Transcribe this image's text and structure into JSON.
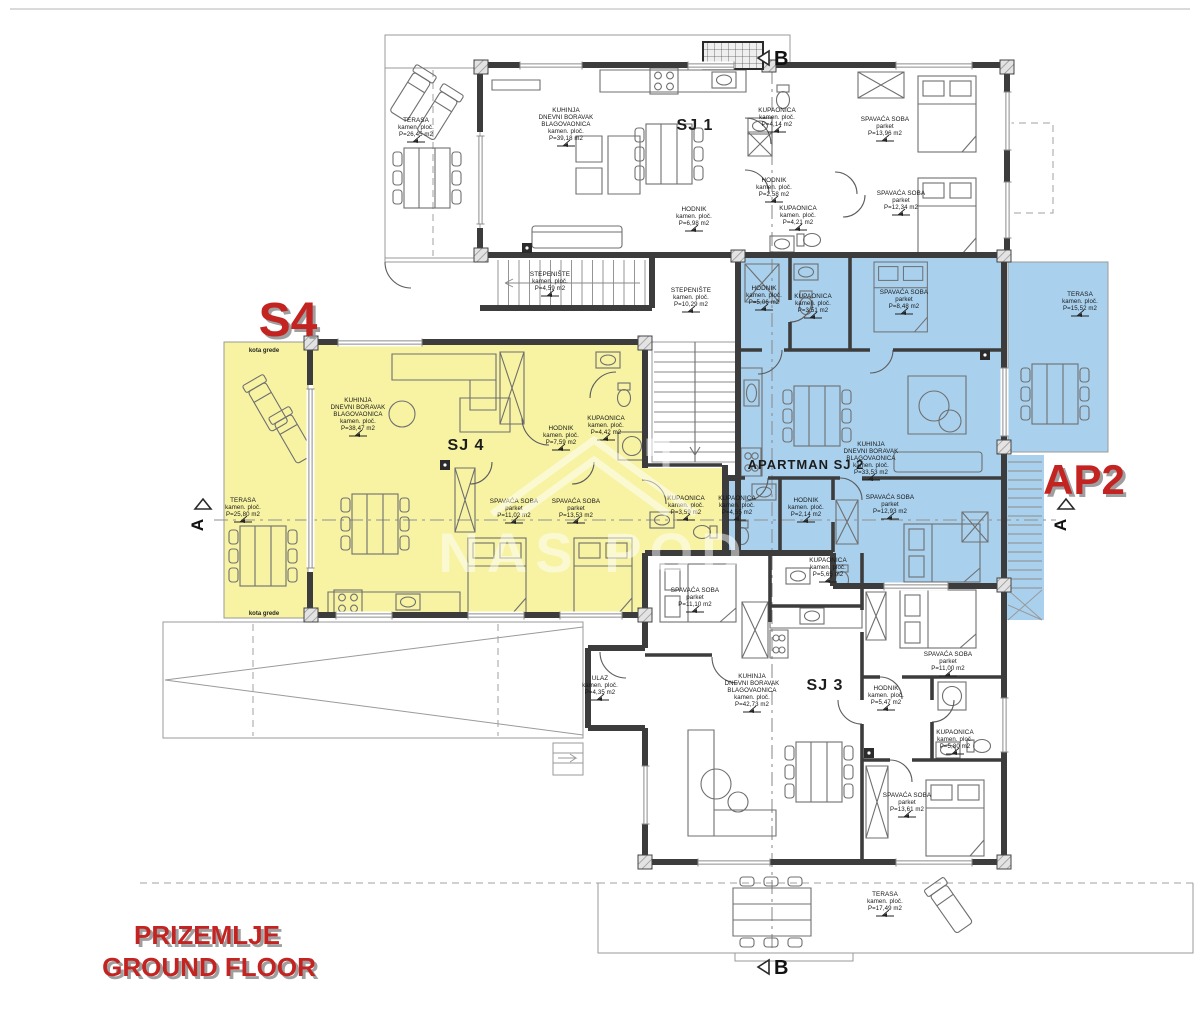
{
  "drawing_type": "floor-plan",
  "floor_title": {
    "croatian": "PRIZEMLJE",
    "english": "GROUND FLOOR"
  },
  "watermark": {
    "text": "NAS POD"
  },
  "colors": {
    "s4_fill": "#f7f3a3",
    "ap2_fill": "#a9d1ee",
    "red": "#c32422",
    "wall": "#3c3c3c"
  },
  "red_labels": [
    {
      "name": "unit-highlight-s4",
      "text": "S4",
      "x": 288,
      "y": 336,
      "size": 48
    },
    {
      "name": "unit-highlight-ap2",
      "text": "AP2",
      "x": 1084,
      "y": 494,
      "size": 42
    },
    {
      "name": "floor-title-croatian",
      "text": "PRIZEMLJE",
      "x": 207,
      "y": 944,
      "size": 26
    },
    {
      "name": "floor-title-english",
      "text": "GROUND FLOOR",
      "x": 209,
      "y": 976,
      "size": 26
    }
  ],
  "units": [
    {
      "id": "sj1",
      "label": "SJ 1",
      "x": 695,
      "y": 130,
      "size": 16
    },
    {
      "id": "sj4",
      "label": "SJ 4",
      "x": 466,
      "y": 450,
      "size": 16
    },
    {
      "id": "apartman-sj2",
      "label": "APARTMAN SJ 2",
      "x": 806,
      "y": 469,
      "size": 13
    },
    {
      "id": "sj3",
      "label": "SJ 3",
      "x": 825,
      "y": 690,
      "size": 16
    }
  ],
  "rooms": [
    {
      "unit": "SJ 1",
      "lines": [
        "TERASA",
        "kamen. ploč.",
        "P=26,45 m2"
      ],
      "x": 416,
      "y": 116
    },
    {
      "unit": "SJ 1",
      "lines": [
        "KUHINJA",
        "DNEVNI BORAVAK",
        "BLAGOVAONICA",
        "kamen. ploč.",
        "P=39,18 m2"
      ],
      "x": 566,
      "y": 106
    },
    {
      "unit": "SJ 1",
      "lines": [
        "KUPAONICA",
        "kamen. ploč.",
        "P=4,14 m2"
      ],
      "x": 777,
      "y": 106
    },
    {
      "unit": "SJ 1",
      "lines": [
        "SPAVAĆA SOBA",
        "parket",
        "P=13,96 m2"
      ],
      "x": 885,
      "y": 115
    },
    {
      "unit": "SJ 1",
      "lines": [
        "HODNIK",
        "kamen. ploč.",
        "P=2,58 m2"
      ],
      "x": 774,
      "y": 176
    },
    {
      "unit": "SJ 1",
      "lines": [
        "KUPAONICA",
        "kamen. ploč.",
        "P=4,21 m2"
      ],
      "x": 798,
      "y": 204
    },
    {
      "unit": "SJ 1",
      "lines": [
        "SPAVAĆA SOBA",
        "parket",
        "P=12,34 m2"
      ],
      "x": 901,
      "y": 189
    },
    {
      "unit": "SJ 1",
      "lines": [
        "HODNIK",
        "kamen. ploč.",
        "P=6,98 m2"
      ],
      "x": 694,
      "y": 205
    },
    {
      "unit": "zajedničko",
      "lines": [
        "STEPENIŠTE",
        "kamen. ploč.",
        "P=4,59 m2"
      ],
      "x": 550,
      "y": 270
    },
    {
      "unit": "zajedničko",
      "lines": [
        "STEPENIŠTE",
        "kamen. ploč.",
        "P=10,29 m2"
      ],
      "x": 691,
      "y": 286
    },
    {
      "unit": "SJ 4",
      "lines": [
        "TERASA",
        "kamen. ploč.",
        "P=25,80 m2"
      ],
      "x": 243,
      "y": 496
    },
    {
      "unit": "SJ 4",
      "lines": [
        "KUHINJA",
        "DNEVNI BORAVAK",
        "BLAGOVAONICA",
        "kamen. ploč.",
        "P=38,47 m2"
      ],
      "x": 358,
      "y": 396
    },
    {
      "unit": "SJ 4",
      "lines": [
        "HODNIK",
        "kamen. ploč.",
        "P=7,59 m2"
      ],
      "x": 561,
      "y": 424
    },
    {
      "unit": "SJ 4",
      "lines": [
        "KUPAONICA",
        "kamen. ploč.",
        "P=4,42 m2"
      ],
      "x": 606,
      "y": 414
    },
    {
      "unit": "SJ 4",
      "lines": [
        "SPAVAĆA SOBA",
        "parket",
        "P=11,02 m2"
      ],
      "x": 514,
      "y": 497
    },
    {
      "unit": "SJ 4",
      "lines": [
        "SPAVAĆA SOBA",
        "parket",
        "P=13,53 m2"
      ],
      "x": 576,
      "y": 497
    },
    {
      "unit": "SJ 4",
      "lines": [
        "KUPAONICA",
        "kamen. ploč.",
        "P=3,59 m2"
      ],
      "x": 686,
      "y": 494
    },
    {
      "unit": "SJ 2",
      "lines": [
        "HODNIK",
        "kamen. ploč.",
        "P=5,06 m2"
      ],
      "x": 764,
      "y": 284
    },
    {
      "unit": "SJ 2",
      "lines": [
        "KUPAONICA",
        "kamen. ploč.",
        "P=3,51 m2"
      ],
      "x": 813,
      "y": 292
    },
    {
      "unit": "SJ 2",
      "lines": [
        "SPAVAĆA SOBA",
        "parket",
        "P=8,48 m2"
      ],
      "x": 904,
      "y": 288
    },
    {
      "unit": "SJ 2",
      "lines": [
        "TERASA",
        "kamen. ploč.",
        "P=15,52 m2"
      ],
      "x": 1080,
      "y": 290
    },
    {
      "unit": "SJ 2",
      "lines": [
        "KUHINJA",
        "DNEVNI BORAVAK",
        "BLAGOVAONICA",
        "kamen. ploč.",
        "P=33,53 m2"
      ],
      "x": 871,
      "y": 440
    },
    {
      "unit": "SJ 2",
      "lines": [
        "KUPAONICA",
        "kamen. ploč.",
        "P=4,55 m2"
      ],
      "x": 737,
      "y": 494
    },
    {
      "unit": "SJ 2",
      "lines": [
        "HODNIK",
        "kamen. ploč.",
        "P=2,14 m2"
      ],
      "x": 806,
      "y": 496
    },
    {
      "unit": "SJ 2",
      "lines": [
        "SPAVAĆA SOBA",
        "parket",
        "P=12,93 m2"
      ],
      "x": 890,
      "y": 493
    },
    {
      "unit": "SJ 3",
      "lines": [
        "ULAZ",
        "kamen. ploč.",
        "P=4,35 m2"
      ],
      "x": 600,
      "y": 674
    },
    {
      "unit": "SJ 3",
      "lines": [
        "SPAVAĆA SOBA",
        "parket",
        "P=11,10 m2"
      ],
      "x": 695,
      "y": 586
    },
    {
      "unit": "SJ 3",
      "lines": [
        "KUPAONICA",
        "kamen. ploč.",
        "P=5,65 m2"
      ],
      "x": 828,
      "y": 556
    },
    {
      "unit": "SJ 3",
      "lines": [
        "KUHINJA",
        "DNEVNI BORAVAK",
        "BLAGOVAONICA",
        "kamen. ploč.",
        "P=42,73 m2"
      ],
      "x": 752,
      "y": 672
    },
    {
      "unit": "SJ 3",
      "lines": [
        "SPAVAĆA SOBA",
        "parket",
        "P=11,00 m2"
      ],
      "x": 948,
      "y": 650
    },
    {
      "unit": "SJ 3",
      "lines": [
        "HODNIK",
        "kamen. ploč.",
        "P=5,47 m2"
      ],
      "x": 886,
      "y": 684
    },
    {
      "unit": "SJ 3",
      "lines": [
        "KUPAONICA",
        "kamen. ploč.",
        "P=5,80 m2"
      ],
      "x": 955,
      "y": 728
    },
    {
      "unit": "SJ 3",
      "lines": [
        "SPAVAĆA SOBA",
        "parket",
        "P=13,61 m2"
      ],
      "x": 907,
      "y": 791
    },
    {
      "unit": "SJ 3",
      "lines": [
        "TERASA",
        "kamen. ploč.",
        "P=17,49 m2"
      ],
      "x": 885,
      "y": 890
    }
  ],
  "annotations": [
    {
      "text": "kota grede",
      "x": 264,
      "y": 352
    },
    {
      "text": "kota grede",
      "x": 264,
      "y": 615
    }
  ],
  "section_markers": [
    {
      "label": "B",
      "x": 772,
      "y": 58,
      "type": "left"
    },
    {
      "label": "B",
      "x": 772,
      "y": 967,
      "type": "left"
    },
    {
      "label": "A",
      "x": 203,
      "y": 513,
      "type": "up"
    },
    {
      "label": "A",
      "x": 1066,
      "y": 513,
      "type": "up"
    }
  ]
}
